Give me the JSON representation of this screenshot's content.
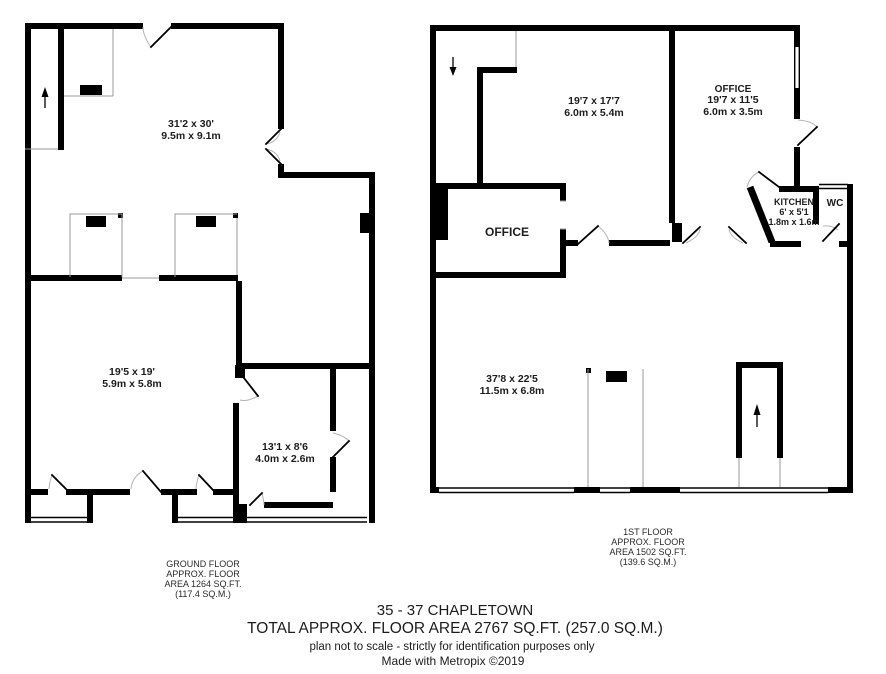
{
  "document": {
    "type_label": "floor plan",
    "colors": {
      "wall": "#000000",
      "thin_line": "#9a9a9a",
      "door_arc": "#b4b4b4",
      "background": "#ffffff",
      "text": "#1c1c1c"
    },
    "icons": {
      "stairs_up": "up-arrow",
      "stairs_down": "down-arrow"
    }
  },
  "ground_floor": {
    "caption": [
      "GROUND FLOOR",
      "APPROX. FLOOR",
      "AREA 1264 SQ.FT.",
      "(117.4 SQ.M.)"
    ],
    "rooms": {
      "main": {
        "dims_ft": "31'2 x 30'",
        "dims_m": "9.5m x 9.1m"
      },
      "rear": {
        "dims_ft": "19'5 x 19'",
        "dims_m": "5.9m x 5.8m"
      },
      "side": {
        "dims_ft": "13'1 x 8'6",
        "dims_m": "4.0m x 2.6m"
      }
    }
  },
  "first_floor": {
    "caption": [
      "1ST FLOOR",
      "APPROX. FLOOR",
      "AREA 1502 SQ.FT.",
      "(139.6 SQ.M.)"
    ],
    "rooms": {
      "front": {
        "dims_ft": "19'7 x 17'7",
        "dims_m": "6.0m x 5.4m"
      },
      "office_right": {
        "name": "OFFICE",
        "dims_ft": "19'7 x 11'5",
        "dims_m": "6.0m x 3.5m"
      },
      "kitchen": {
        "name": "KITCHEN",
        "dims_ft": "6' x 5'1",
        "dims_m": "1.8m x 1.6m"
      },
      "wc": {
        "name": "WC"
      },
      "office_box": {
        "name": "OFFICE"
      },
      "open_plan": {
        "dims_ft": "37'8 x 22'5",
        "dims_m": "11.5m x 6.8m"
      }
    }
  },
  "footer": {
    "property": "35 - 37 CHAPLETOWN",
    "total_area": "TOTAL APPROX. FLOOR AREA 2767 SQ.FT. (257.0 SQ.M.)",
    "disclaimer": "plan not to scale - strictly for identification purposes only",
    "credit": "Made with Metropix ©2019"
  }
}
